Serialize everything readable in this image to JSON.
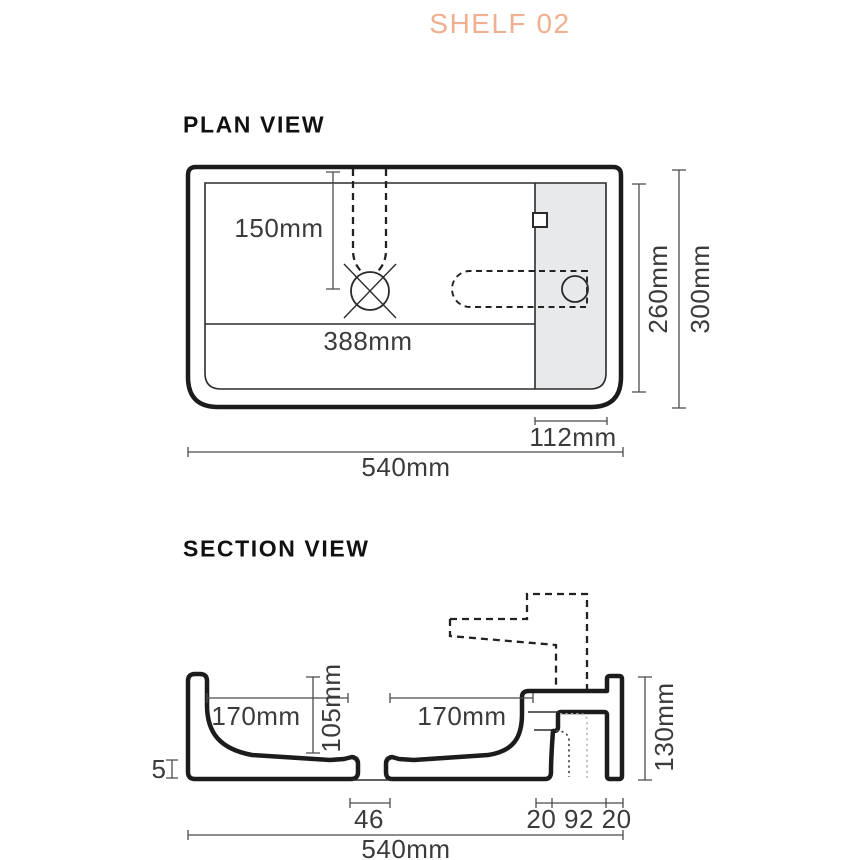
{
  "title": "SHELF 02",
  "colors": {
    "accent": "#F0AF8E",
    "outline": "#1C1C1E",
    "thin_line": "#2B2B2D",
    "dimension": "#4B4B4D",
    "shelf_shade": "#E8E9EA",
    "hidden_pipe_light": "#B9B9BB"
  },
  "plan": {
    "heading": "PLAN VIEW",
    "dims": {
      "tap_setback": "150mm",
      "basin_width": "388mm",
      "inner_depth": "260mm",
      "overall_depth": "300mm",
      "shelf_width": "112mm",
      "overall_width": "540mm"
    }
  },
  "section": {
    "heading": "SECTION VIEW",
    "dims": {
      "left_basin": "170mm",
      "right_basin": "170mm",
      "bowl_depth": "105mm",
      "shelf_height": "130mm",
      "base_thickness": "5",
      "drain_width": "46",
      "bracket_widths": "20 92 20",
      "overall_width": "540mm"
    }
  }
}
